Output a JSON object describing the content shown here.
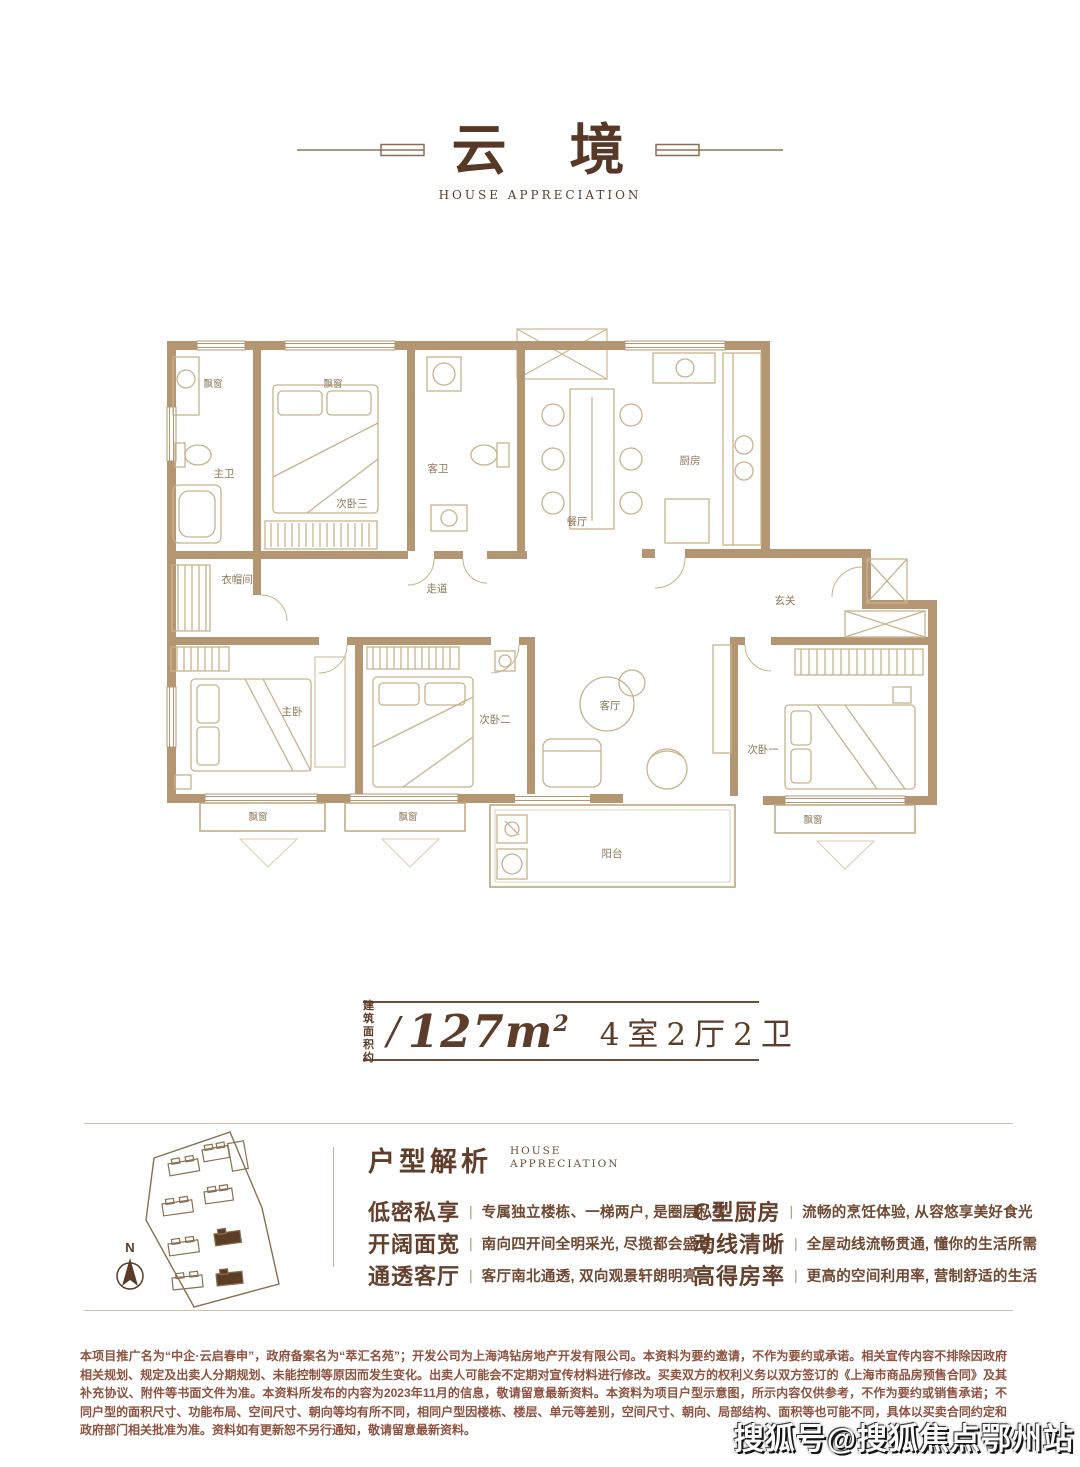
{
  "header": {
    "title": "云　境",
    "subtitle": "HOUSE APPRECIATION"
  },
  "floorplan": {
    "labels": {
      "bay_window": "飘窗",
      "master_bath": "主卫",
      "bedroom3": "次卧三",
      "guest_bath": "客卫",
      "dining": "餐厅",
      "kitchen": "厨房",
      "cloakroom": "衣帽间",
      "corridor": "走道",
      "foyer": "玄关",
      "master_bedroom": "主卧",
      "bedroom2": "次卧二",
      "living": "客厅",
      "bedroom1": "次卧一",
      "balcony": "阳台"
    }
  },
  "area": {
    "prefix_line1": "建筑",
    "prefix_line2": "面积约",
    "separator": "/",
    "value_main": "127m",
    "value_sup": "2",
    "rooms": "4室2厅2卫"
  },
  "sitemap": {
    "compass_label": "N"
  },
  "analysis": {
    "title": "户型解析",
    "subtitle_line1": "HOUSE",
    "subtitle_line2": "APPRECIATION",
    "divider": "|",
    "features": [
      {
        "heading": "低密私享",
        "desc": "专属独立楼栋、一梯两户, 是圈层私享"
      },
      {
        "heading": "开阔面宽",
        "desc": "南向四开间全明采光, 尽揽都会盛景"
      },
      {
        "heading": "通透客厅",
        "desc": "客厅南北通透, 双向观景轩朗明亮"
      },
      {
        "heading": "C型厨房",
        "desc": "流畅的烹饪体验, 从容悠享美好食光"
      },
      {
        "heading": "动线清晰",
        "desc": "全屋动线流畅贯通, 懂你的生活所需"
      },
      {
        "heading": "高得房率",
        "desc": "更高的空间利用率, 营制舒适的生活"
      }
    ]
  },
  "disclaimer": "本项目推广名为“中企·云启春申”，政府备案名为“萃汇名苑”；开发公司为上海鸿钻房地产开发有限公司。本资料为要约邀请，不作为要约或承诺。相关宣传内容不排除因政府相关规划、规定及出卖人分期规划、未能控制等原因而发生变化。出卖人可能会不定期对宣传材料进行修改。买卖双方的权利义务以双方签订的《上海市商品房预售合同》及其补充协议、附件等书面文件为准。本资料所发布的内容为2023年11月的信息，敬请留意最新资料。本资料为项目户型示意图，所示内容仅供参考，不作为要约或销售承诺；不同户型的面积尺寸、功能布局、空间尺寸、朝向等均有所不同，相同户型因楼栋、楼层、单元等差别，空间尺寸、朝向、局部结构、面积等也可能不同，具体以买卖合同约定和政府部门相关批准为准。资料如有更新恕不另行通知，敬请留意最新资料。",
  "watermark": "搜狐号@搜狐焦点鄂州站",
  "colors": {
    "wall": "#b49772",
    "furniture_line": "#c9b28d",
    "label_text": "#8d7656",
    "accent_brown": "#5f3d2a",
    "disclaimer_text": "#8e5240"
  }
}
